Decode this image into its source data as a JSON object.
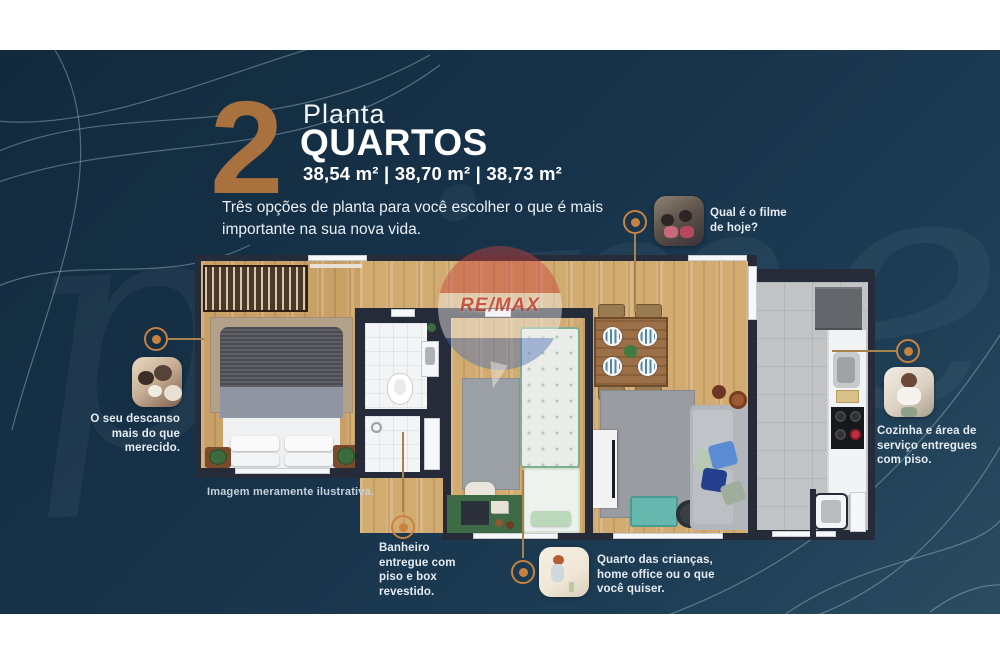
{
  "colors": {
    "panel_navy": "#17334a",
    "accent_bronze": "#a8713e",
    "marker_orange": "#c8823f",
    "remax_red": "#c23b32"
  },
  "header": {
    "number": "2",
    "title_light": "Planta",
    "title_bold": "QUARTOS",
    "areas": "38,54 m² | 38,70 m² | 38,73 m²",
    "subtitle_line1": "Três opções de planta para você escolher o que é mais",
    "subtitle_line2": "importante na sua nova vida."
  },
  "floorplan": {
    "disclaimer": "Imagem meramente ilustrativa.",
    "watermark": "RE/MAX",
    "background_script": "prime"
  },
  "callouts": {
    "descanso": {
      "photo": "family-resting-photo",
      "lines": [
        "O seu descanso",
        "mais do que",
        "merecido."
      ]
    },
    "filme": {
      "photo": "family-movie-photo",
      "lines": [
        "Qual é o filme",
        "de hoje?"
      ]
    },
    "cozinha": {
      "photo": "woman-cooking-photo",
      "lines": [
        "Cozinha e área de",
        "serviço entregues",
        "com piso."
      ]
    },
    "banheiro": {
      "lines": [
        "Banheiro",
        "entregue com",
        "piso e box",
        "revestido."
      ]
    },
    "quarto": {
      "photo": "child-playing-photo",
      "lines": [
        "Quarto das crianças,",
        "home office ou o que",
        "você quiser."
      ]
    }
  }
}
